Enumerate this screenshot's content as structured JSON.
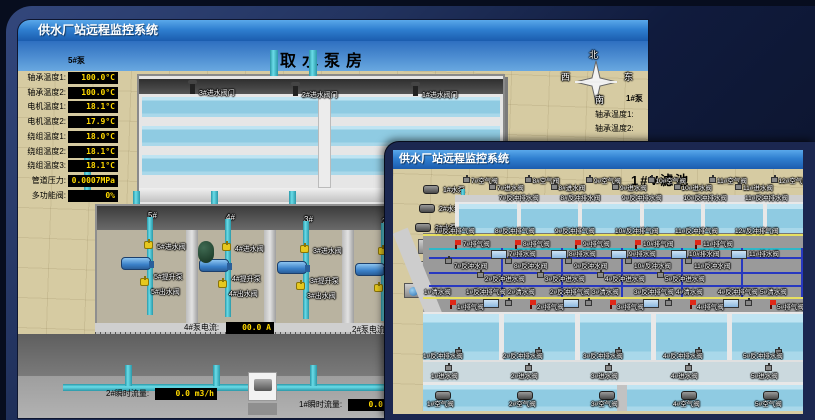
{
  "back_window": {
    "title": "供水厂站远程监控系统",
    "scene_title": "取水泵房",
    "compass": {
      "north": "北",
      "west": "西",
      "south": "南",
      "east": "东"
    },
    "left_panel": {
      "header": "5#泵",
      "rows": [
        {
          "label": "轴承温度1:",
          "value": "100.0°C"
        },
        {
          "label": "轴承温度2:",
          "value": "100.0°C"
        },
        {
          "label": "电机温度1:",
          "value": "18.1°C"
        },
        {
          "label": "电机温度2:",
          "value": "17.9°C"
        },
        {
          "label": "绕组温度1:",
          "value": "18.0°C"
        },
        {
          "label": "绕组温度2:",
          "value": "18.1°C"
        },
        {
          "label": "绕组温度3:",
          "value": "18.1°C"
        },
        {
          "label": "管道压力:",
          "value": "0.0007MPa"
        },
        {
          "label": "多功能阀:",
          "value": "0%"
        }
      ]
    },
    "right_panel": {
      "header": "1#泵",
      "rows": [
        "轴承温度1:",
        "轴承温度2:"
      ]
    },
    "inlet_gates": [
      "3#进水阀门",
      "2#进水阀门",
      "1#进水阀门"
    ],
    "bays": [
      {
        "no": "5#",
        "inlet": "5#进水阀",
        "pump": "5#提升泵",
        "outlet": "5#出水阀"
      },
      {
        "no": "4#",
        "inlet": "4#进水阀",
        "pump": "4#提升泵",
        "outlet": "4#出水阀"
      },
      {
        "no": "3#",
        "inlet": "3#进水阀",
        "pump": "3#提升泵",
        "outlet": "3#出水阀"
      },
      {
        "no": "2#",
        "inlet": "2#进水阀",
        "pump": "2#提升泵",
        "outlet": "2#出水阀"
      }
    ],
    "current_readout": {
      "label": "4#泵电流:",
      "value": "00.0 A"
    },
    "current_readout2": {
      "label": "2#泵电流:"
    },
    "flow_left": {
      "label": "2#瞬时流量:",
      "value": "0.0 m3/h"
    },
    "flow_right": {
      "label": "1#瞬时流量:",
      "value": "0.0 m3/h"
    }
  },
  "front_window": {
    "title": "供水厂站远程监控系统",
    "scene_title": "1#V滤池",
    "equipment": {
      "pumps": [
        "1#水泵",
        "2#水泵",
        "3#水泵"
      ],
      "blowers": [
        "1#风机",
        "2#风机",
        "3#风机"
      ]
    },
    "top_cells": {
      "air": [
        "7#空气阀",
        "8#空气阀",
        "9#空气阀",
        "10#空气阀",
        "11#空气阀",
        "12#空气阀"
      ],
      "inlet": [
        "7#进水阀",
        "8#进水阀",
        "9#进水阀",
        "10#进水阀",
        "11#进水阀"
      ],
      "drain": [
        "7#反冲排水阀",
        "8#反冲排水阀",
        "9#反冲排水阀",
        "10#反冲排水阀",
        "11#反冲排水阀"
      ]
    },
    "gallery": {
      "backwash_vent": [
        "7#反冲排气阀",
        "8#反冲排气阀",
        "9#反冲排气阀",
        "10#反冲排气阀",
        "11#反冲排气阀",
        "12#反冲排气阀"
      ],
      "vent": [
        "7#排气阀",
        "8#排气阀",
        "9#排气阀",
        "10#排气阀",
        "11#排气阀"
      ],
      "drain_box": [
        "7#排水阀",
        "8#排水阀",
        "9#排水阀",
        "10#排水阀",
        "11#排水阀"
      ],
      "backwash_water": [
        "7#反冲水阀",
        "8#反冲水阀",
        "9#反冲水阀",
        "10#反冲水阀",
        "11#反冲水阀"
      ],
      "backwash_inlet": [
        "2#反冲进水阀",
        "3#反冲进水阀",
        "4#反冲进水阀",
        "5#反冲进水阀"
      ],
      "clean_rail": [
        "1#清水阀",
        "1#反冲排气阀",
        "2#清水阀",
        "2#反冲排气阀",
        "3#清水阀",
        "3#反冲排气阀",
        "4#清水阀",
        "4#反冲排气阀",
        "5#清水阀"
      ],
      "bottom_vent": [
        "1#排气阀",
        "2#排气阀",
        "3#排气阀",
        "4#排气阀",
        "5#排气阀"
      ]
    },
    "bottom_cells": {
      "drain": [
        "1#反冲排水阀",
        "2#反冲排水阀",
        "3#反冲排水阀",
        "4#反冲排水阀",
        "5#反冲排水阀"
      ],
      "inlet": [
        "1#进水阀",
        "2#进水阀",
        "3#进水阀",
        "4#进水阀",
        "5#进水阀"
      ],
      "air": [
        "1#空气阀",
        "2#空气阀",
        "3#空气阀",
        "4#空气阀",
        "5#空气阀"
      ]
    }
  }
}
